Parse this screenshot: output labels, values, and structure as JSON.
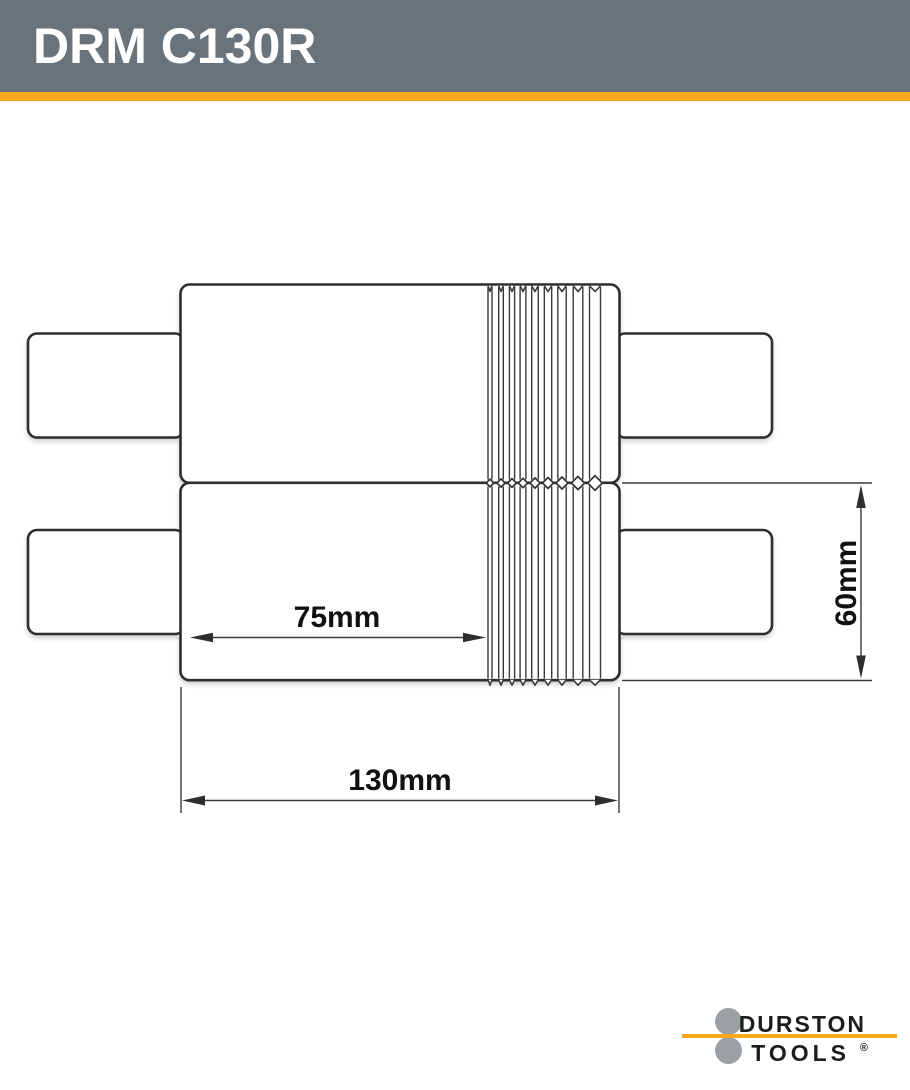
{
  "header": {
    "title": "DRM C130R"
  },
  "diagram": {
    "description": "Technical dimension drawing of two stacked rolling-mill rollers with shafts and wire grooves",
    "dim_flat_face_width": "75mm",
    "dim_total_roller_width": "130mm",
    "dim_roller_diameter": "60mm"
  },
  "logo": {
    "brand_line1": "DURSTON",
    "brand_line2": "TOOLS",
    "registered_mark": "®"
  },
  "colors": {
    "header_bg": "#69737B",
    "accent_orange": "#F8A81D",
    "drawing_line": "#3A3A3A",
    "logo_circle_gray": "#9BA0A4",
    "logo_text": "#1D1D1B"
  }
}
